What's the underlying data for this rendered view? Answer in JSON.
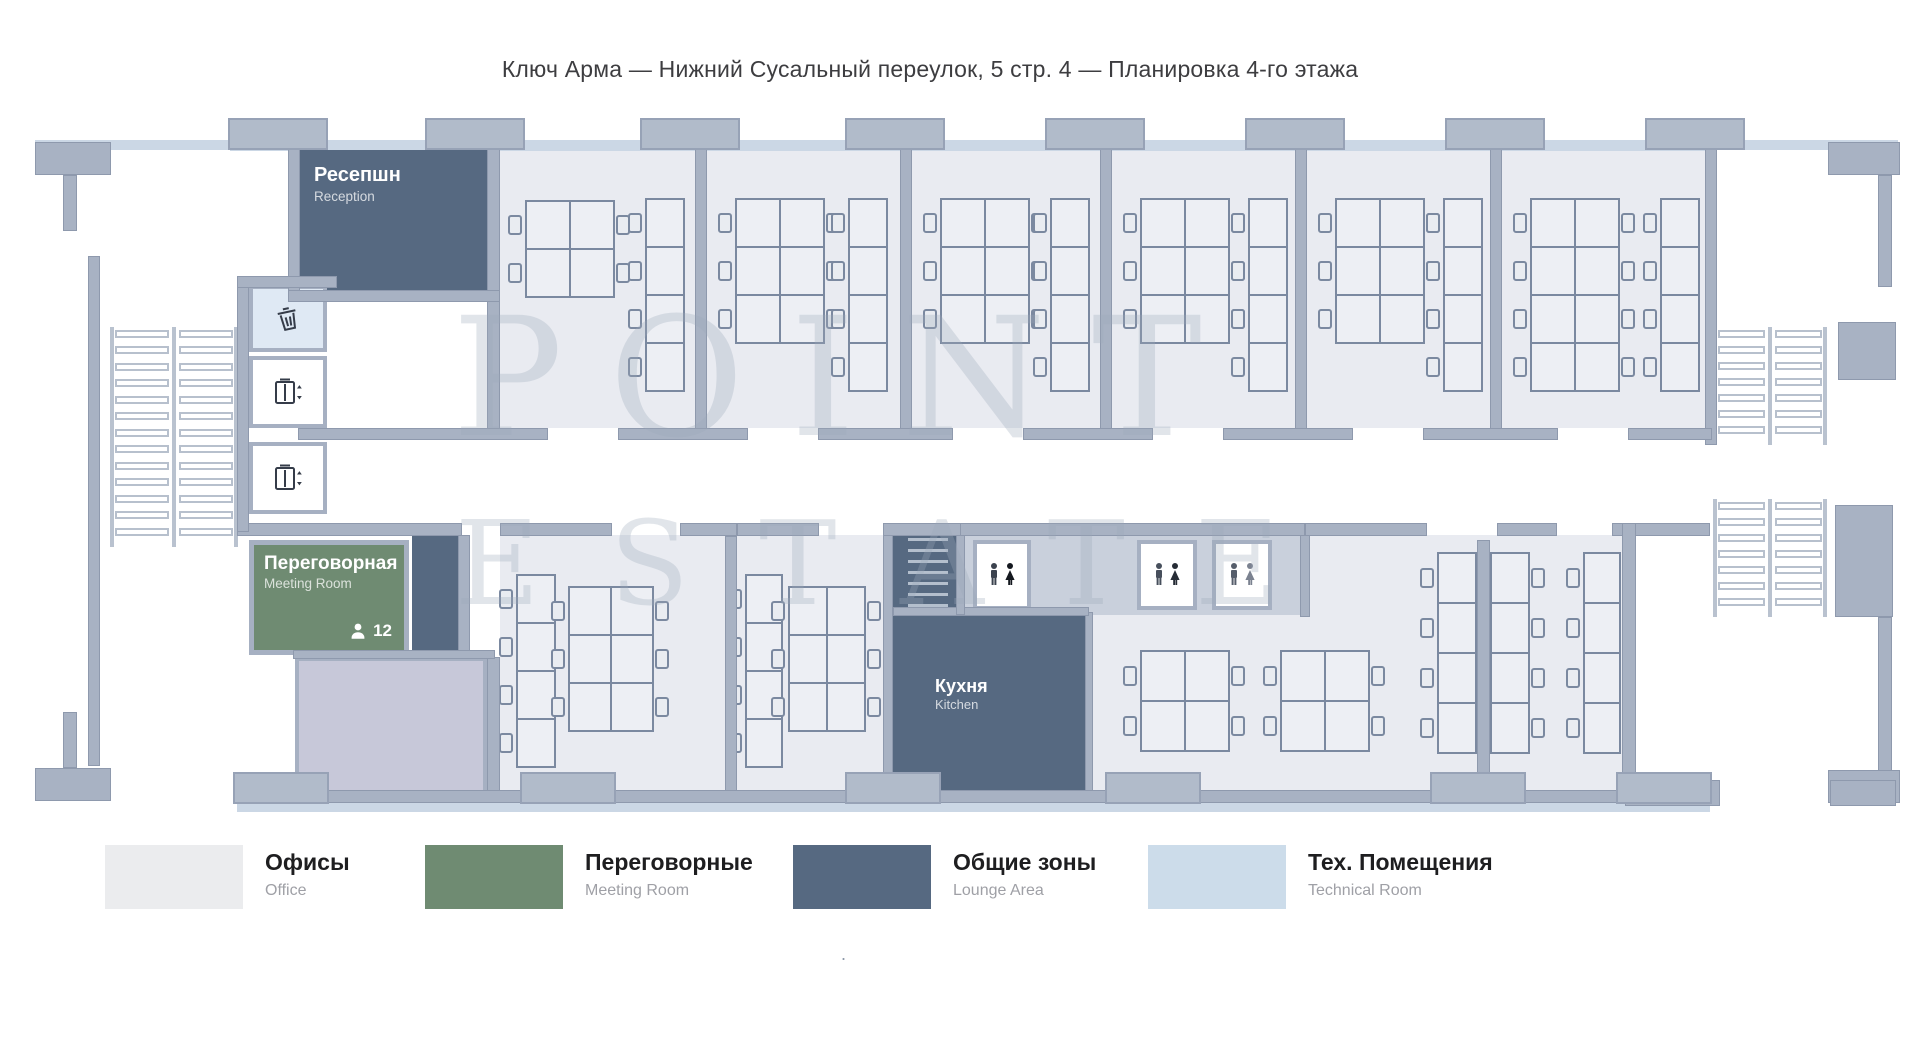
{
  "title": "Ключ Арма — Нижний Сусальный переулок, 5 стр. 4 — Планировка 4-го этажа",
  "watermark": {
    "line1": "POINT",
    "line2": "ESTATE"
  },
  "rooms": {
    "reception": {
      "name_ru": "Ресепшн",
      "name_en": "Reception"
    },
    "meeting": {
      "name_ru": "Переговорная",
      "name_en": "Meeting Room",
      "capacity": "12"
    },
    "kitchen": {
      "name_ru": "Кухня",
      "name_en": "Kitchen"
    }
  },
  "icons": {
    "trash": "trash-icon",
    "elevator": "elevator-icon",
    "wc": "wc-icon",
    "person": "person-icon"
  },
  "legend": {
    "items": [
      {
        "label_ru": "Офисы",
        "label_en": "Office",
        "color": "#ebecee"
      },
      {
        "label_ru": "Переговорные",
        "label_en": "Meeting Room",
        "color": "#6f8b72"
      },
      {
        "label_ru": "Общие зоны",
        "label_en": "Lounge Area",
        "color": "#566981"
      },
      {
        "label_ru": "Тех. Помещения",
        "label_en": "Technical Room",
        "color": "#ccdcea"
      }
    ]
  },
  "palette": {
    "wall": "#a8b2c3",
    "office_floor": "#e9ebf1",
    "corridor": "#ffffff",
    "technical_light": "#dfe9f4",
    "lavender": "#c7c8d9",
    "dark_zone": "#566981",
    "meeting_green": "#6f8b72"
  },
  "footnote_dot": "."
}
